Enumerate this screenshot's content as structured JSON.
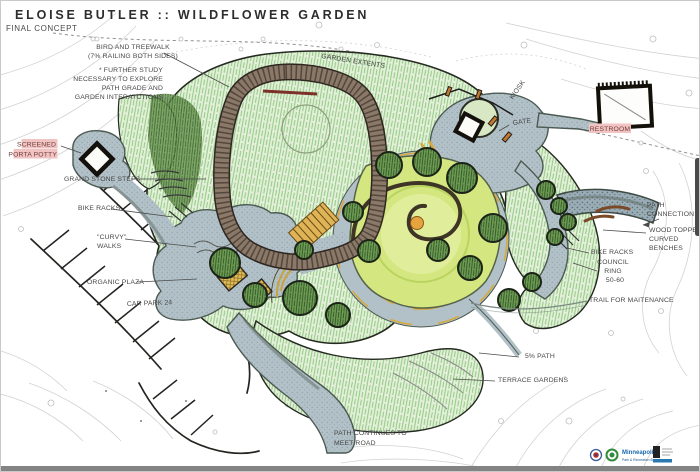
{
  "title": {
    "main": "ELOISE BUTLER :: WILDFLOWER GARDEN",
    "subtitle": "FINAL CONCEPT"
  },
  "labels": {
    "bird_treewalk_line1": "BIRD AND TREEWALK",
    "bird_treewalk_line2": "(7% RAILING BOTH SIDES)",
    "further_study_line1": "* FURTHER STUDY",
    "further_study_line2": "NECESSARY TO EXPLORE",
    "further_study_line3": "PATH GRADE AND",
    "further_study_line4": "GARDEN INTERATCTIONS",
    "garden_extents": "GARDEN EXTENTS",
    "kiosk": "KIOSK",
    "gate": "GATE",
    "restroom": "RESTROOM",
    "porta_line1": "SCREENED",
    "porta_line2": "PORTA POTTY",
    "grand_stone_steps": "GRAND STONE STEPS",
    "bike_racks_left": "BIKE RACKS",
    "curvy_line1": "\"CURVY\"",
    "curvy_line2": "WALKS",
    "organic_plaza": "ORGANIC PLAZA",
    "car_park": "CAR PARK 24",
    "path_connection_line1": "PATH",
    "path_connection_line2": "CONNECTION",
    "wood_benches_line1": "WOOD TOPPED",
    "wood_benches_line2": "CURVED",
    "wood_benches_line3": "BENCHES",
    "bike_racks_right": "BIKE RACKS",
    "council_line1": "COUNCIL",
    "council_line2": "RING",
    "council_line3": "50-60",
    "trail_maintenance": "TRAIL FOR MAITENANCE",
    "five_percent_path": "5% PATH",
    "terrace_gardens": "TERRACE GARDENS",
    "path_continues_line1": "PATH CONTINUES TO",
    "path_continues_line2": "MEET ROAD"
  },
  "footer": {
    "org": "Minneapolis",
    "org_sub": "Park & Recreation Board"
  },
  "colors": {
    "highlight_pink": "#f2c3c3",
    "label_gray": "#474747",
    "veg_green": "#7cc46f",
    "garden_green": "#d3e67f",
    "boardwalk_brown": "#8a7868",
    "path_gray": "#b2c1c8",
    "accent_gold": "#d8a93c",
    "footer_blue": "#1a6ab0",
    "bottom_bar_gray": "#838383"
  }
}
